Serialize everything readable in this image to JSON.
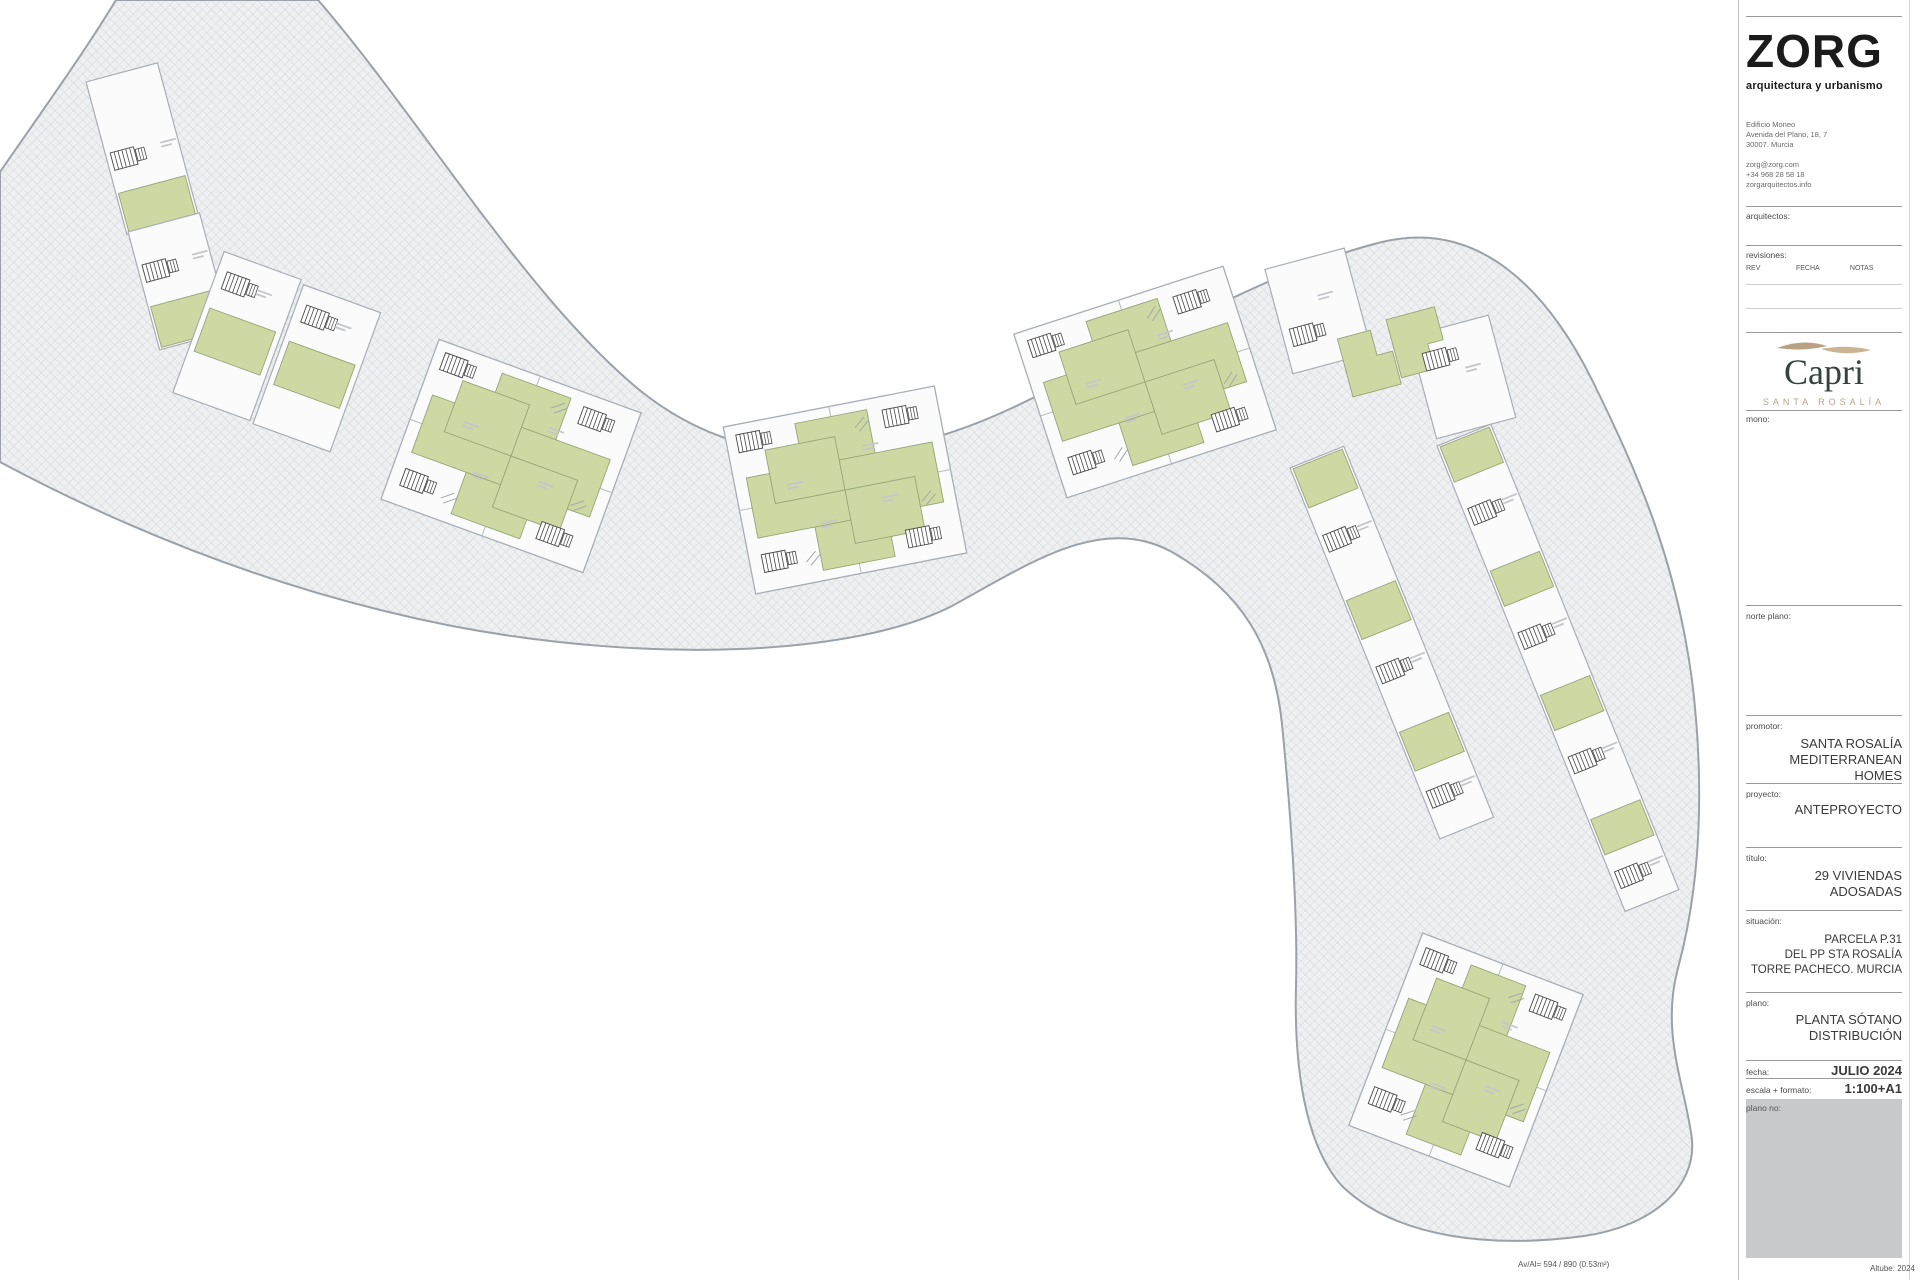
{
  "titleblock": {
    "logo": {
      "name": "ZORG",
      "tagline": "arquitectura y urbanismo"
    },
    "address_lines": [
      "Edificio Moneo",
      "Avenida del Plano, 18, 7",
      "30007. Murcia"
    ],
    "contact_lines": [
      "zorg@zorg.com",
      "+34 968 28 58 18",
      "zorgarquitectos.info"
    ],
    "labels": {
      "arquitectos": "arquitectos:",
      "revisiones": "revisiones:",
      "rev": "REV",
      "fecha_col": "FECHA",
      "notas": "NOTAS",
      "mono": "mono:",
      "norte": "norte plano:",
      "promotor": "promotor:",
      "proyecto": "proyecto:",
      "titulo": "título:",
      "situacion": "situación:",
      "plano": "plano:",
      "fecha": "fecha:",
      "escala": "escala + formato:",
      "plano_no": "plano no:"
    },
    "brand": {
      "name": "Capri",
      "sub": "SANTA ROSALÍA"
    },
    "promotor_value": [
      "SANTA ROSALÍA",
      "MEDITERRANEAN HOMES"
    ],
    "proyecto_value": "ANTEPROYECTO",
    "titulo_value": [
      "29 VIVIENDAS",
      "ADOSADAS"
    ],
    "situacion_value": [
      "PARCELA P.31",
      "DEL PP STA ROSALÍA",
      "TORRE PACHECO. MURCIA"
    ],
    "plano_value": [
      "PLANTA SÓTANO",
      "DISTRIBUCIÓN"
    ],
    "fecha_value": "JULIO 2024",
    "escala_value": "1:100+A1"
  },
  "footer": {
    "left": "Av/Al= 594 / 890 (0.53m²)",
    "right": "Altube: 2024"
  },
  "plan": {
    "colors": {
      "hatch_bg": "#eef0f2",
      "hatch_line": "#d3d6da",
      "band_stroke": "#9ba1a8",
      "plot_fill": "#fbfbfc",
      "plot_stroke": "#a9aeb6",
      "green": "#cdd8a3",
      "green_stroke": "#96a577",
      "stair": "#474747",
      "divider": "#b8bcc2",
      "mark": "#c4c6c9",
      "ramp": "#a3a8ae",
      "mini_fill": "#d8dadd",
      "mini_stroke": "#9096a0"
    },
    "band_path": "M 116,0 L 318,0 C 420,118 530,302 642,392 C 748,476 884,468 1012,408 C 1152,342 1262,272 1382,242 C 1478,219 1548,288 1596,388 C 1640,478 1676,562 1692,680 C 1704,778 1702,880 1678,968 C 1660,1034 1686,1088 1692,1140 C 1696,1186 1654,1226 1584,1236 C 1496,1248 1398,1240 1342,1186 C 1304,1144 1294,1064 1296,986 C 1298,908 1290,806 1282,724 C 1274,646 1242,592 1172,552 C 1102,514 1032,562 952,606 C 854,656 652,664 452,626 C 300,596 150,542 0,462 L 0,172 C 40,114 82,56 116,0 Z",
    "clusters": [
      {
        "type": "strip",
        "x": 86,
        "y": 82,
        "rot": -15,
        "w": 74,
        "segs": [
          [
            "plain",
            58
          ],
          [
            "stair",
            56
          ],
          [
            "green",
            44
          ]
        ]
      },
      {
        "type": "strip",
        "x": 128,
        "y": 232,
        "rot": -15,
        "w": 74,
        "segs": [
          [
            "plain",
            18
          ],
          [
            "stair",
            58
          ],
          [
            "green",
            46
          ]
        ]
      },
      {
        "type": "pair2",
        "cx": 278,
        "cy": 352,
        "rot": 20,
        "w": 170,
        "h": 152
      },
      {
        "type": "quad",
        "cx": 511,
        "cy": 456,
        "w": 215,
        "h": 170,
        "rot": 20
      },
      {
        "type": "quad",
        "cx": 845,
        "cy": 490,
        "w": 215,
        "h": 170,
        "rot": -11
      },
      {
        "type": "quad",
        "cx": 1145,
        "cy": 382,
        "w": 220,
        "h": 172,
        "rot": -18
      },
      {
        "type": "pairDiag",
        "cx": 1390,
        "cy": 342,
        "rot": -15,
        "w": 204,
        "h": 205
      },
      {
        "type": "strip",
        "x": 1290,
        "y": 468,
        "rot": -22,
        "w": 58,
        "segs": [
          [
            "green",
            46
          ],
          [
            "stair",
            96
          ],
          [
            "green",
            46
          ],
          [
            "stair",
            96
          ],
          [
            "green",
            46
          ],
          [
            "stair",
            70
          ]
        ]
      },
      {
        "type": "strip",
        "x": 1437,
        "y": 446,
        "rot": -22,
        "w": 58,
        "segs": [
          [
            "green",
            42
          ],
          [
            "stair",
            92
          ],
          [
            "green",
            42
          ],
          [
            "stair",
            92
          ],
          [
            "green",
            42
          ],
          [
            "stair",
            92
          ],
          [
            "green",
            42
          ],
          [
            "stair",
            58
          ]
        ]
      },
      {
        "type": "quad",
        "cx": 1466,
        "cy": 1060,
        "w": 172,
        "h": 206,
        "rot": 21
      }
    ],
    "minimap": {
      "scale": 0.086,
      "tx": 1753,
      "ty": 450
    },
    "north": {
      "cx": 1828,
      "cy": 662,
      "r": 18
    }
  }
}
